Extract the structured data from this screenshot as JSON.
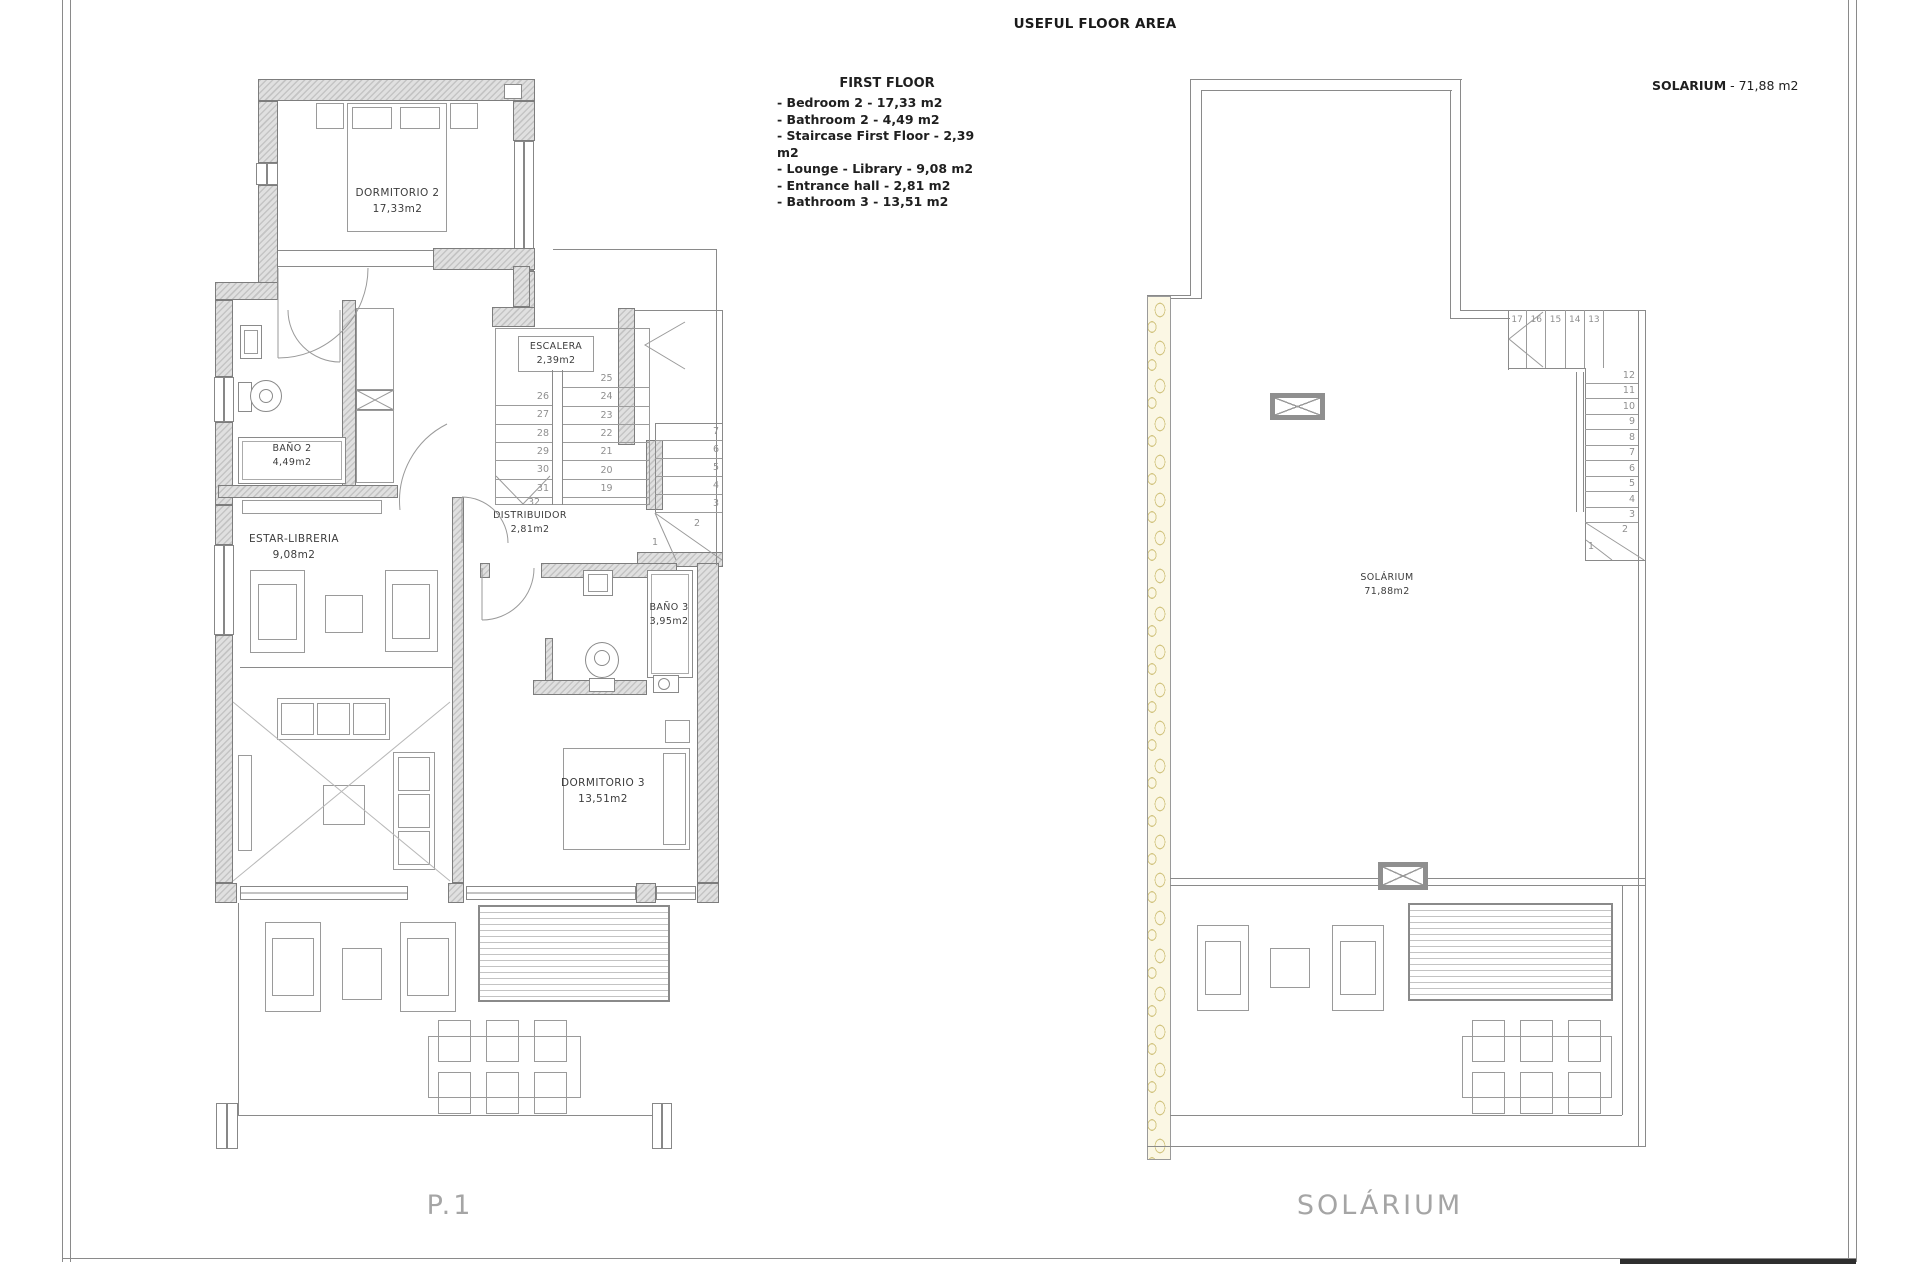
{
  "page": {
    "title": "USEFUL FLOOR AREA"
  },
  "legend": {
    "heading": "FIRST FLOOR",
    "items": [
      "- Bedroom 2 - 17,33 m2",
      "- Bathroom 2 - 4,49 m2",
      "- Staircase First Floor - 2,39 m2",
      "- Lounge - Library - 9,08 m2",
      "- Entrance hall - 2,81 m2",
      "- Bathroom 3 - 13,51 m2"
    ]
  },
  "solarium_note": {
    "label": "SOLARIUM",
    "value": "- 71,88 m2"
  },
  "plan1": {
    "caption": "P.1",
    "rooms": {
      "dormitorio2": {
        "name": "DORMITORIO 2",
        "area": "17,33m2"
      },
      "bano2": {
        "name": "BAÑO 2",
        "area": "4,49m2"
      },
      "escalera": {
        "name": "ESCALERA",
        "area": "2,39m2"
      },
      "distribuidor": {
        "name": "DISTRIBUIDOR",
        "area": "2,81m2"
      },
      "estar": {
        "name": "ESTAR-LIBRERIA",
        "area": "9,08m2"
      },
      "bano3": {
        "name": "BAÑO 3",
        "area": "3,95m2"
      },
      "dormitorio3": {
        "name": "DORMITORIO 3",
        "area": "13,51m2"
      }
    },
    "stair_main": {
      "left_numbers": [
        "26",
        "27",
        "28",
        "29",
        "30",
        "31"
      ],
      "right_numbers": [
        "25",
        "24",
        "23",
        "22",
        "21",
        "20",
        "19"
      ],
      "bottom_number": "32"
    },
    "stair_entry": {
      "numbers": [
        "7",
        "6",
        "5",
        "4",
        "3"
      ],
      "winder_numbers": {
        "n2": "2",
        "n1": "1"
      }
    }
  },
  "plan2": {
    "caption": "SOLÁRIUM",
    "room": {
      "name": "SOLÁRIUM",
      "area": "71,88m2"
    },
    "stair": {
      "top_numbers": [
        "17",
        "16",
        "15",
        "14",
        "13"
      ],
      "side_numbers": [
        "12",
        "11",
        "10",
        "9",
        "8",
        "7",
        "6",
        "5",
        "4",
        "3"
      ],
      "winder_numbers": {
        "n2": "2",
        "n1": "1"
      }
    }
  }
}
